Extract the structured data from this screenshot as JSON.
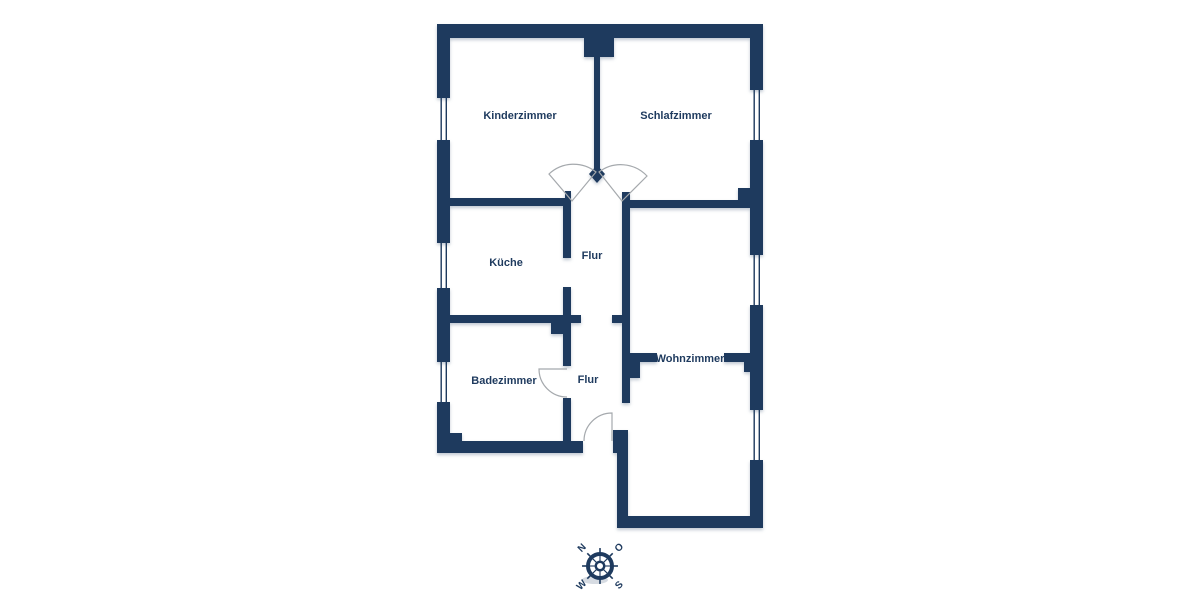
{
  "rooms": [
    {
      "id": "kinderzimmer",
      "label": "Kinderzimmer"
    },
    {
      "id": "schlafzimmer",
      "label": "Schlafzimmer"
    },
    {
      "id": "kueche",
      "label": "Küche"
    },
    {
      "id": "flur-oben",
      "label": "Flur"
    },
    {
      "id": "badezimmer",
      "label": "Badezimmer"
    },
    {
      "id": "flur-unten",
      "label": "Flur"
    },
    {
      "id": "wohnzimmer",
      "label": "Wohnzimmer"
    }
  ],
  "compass": {
    "north": "N",
    "east": "O",
    "south": "S",
    "west": "W"
  },
  "colors": {
    "wall": "#1e3a5e",
    "label_text": "#1e3a5e",
    "door_arc": "#a5a9ad",
    "background": "#ffffff"
  }
}
